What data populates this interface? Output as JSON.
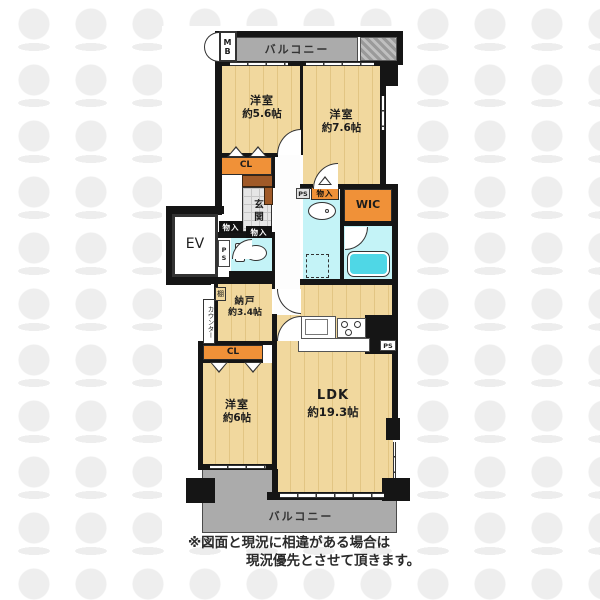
{
  "floorplan": {
    "balcony_top_label": "バルコニー",
    "balcony_bottom_label": "バルコニー",
    "mb_label": "MB",
    "ev_label": "EV",
    "rooms": {
      "bedroom1": {
        "name": "洋室",
        "area": "約5.6帖"
      },
      "bedroom2": {
        "name": "洋室",
        "area": "約7.6帖"
      },
      "bedroom3": {
        "name": "洋室",
        "area": "約6帖"
      },
      "nando": {
        "name": "納戸",
        "area": "約3.4帖"
      },
      "ldk": {
        "name": "LDK",
        "area": "約19.3帖"
      }
    },
    "closets": {
      "cl_top": "CL",
      "cl_bottom": "CL",
      "wic": "WIC",
      "monoire_a": "物入",
      "monoire_b": "物入",
      "monoire_c": "物入"
    },
    "utility": {
      "ps_a": "PS",
      "ps_b": "PS",
      "ps_c": "PS",
      "genkan": "玄関",
      "tana": "棚",
      "counter": "カウンター"
    },
    "icons": {
      "toilet-icon": "css-shape",
      "bathtub-icon": "css-rounded-rect",
      "sink-icon": "css-ellipse",
      "kitchen-sink-icon": "css-rect",
      "stove-icon": "css-circles",
      "washer-space-icon": "css-dashed-box",
      "door-arc-icon": "css-quarter-circle",
      "closet-door-icon": "css-triangle"
    },
    "colors": {
      "floor": "#f1d89e",
      "balcony": "#ababab",
      "wet_area": "#c4f3f7",
      "bathtub": "#4fd7e6",
      "closet": "#f09138",
      "shoe_cabinet": "#a05a28",
      "wall": "#151515"
    }
  },
  "disclaimer": {
    "line1": "※図面と現況に相違がある場合は",
    "line2": "現況優先とさせて頂きます。"
  }
}
